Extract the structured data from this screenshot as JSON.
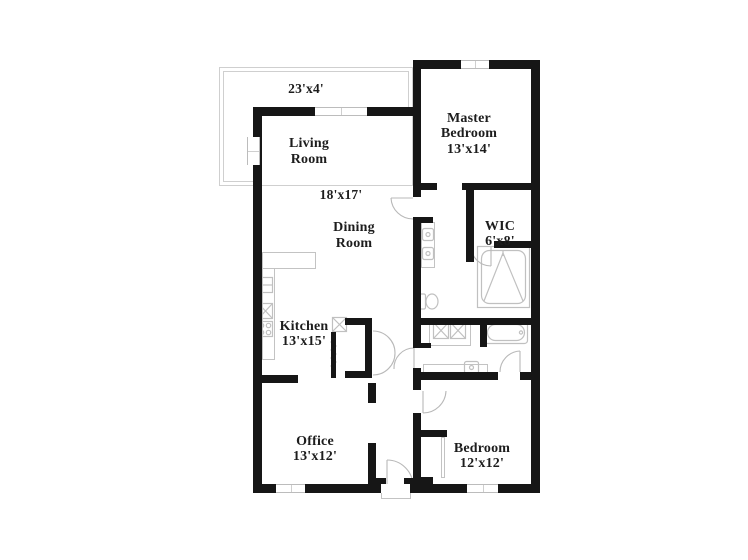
{
  "page": {
    "kind": "floor-plan"
  },
  "labels": {
    "patio_dims": "23'x4'",
    "living": {
      "name": "Living\nRoom",
      "dims": "18'x17'"
    },
    "dining": {
      "name": "Dining\nRoom"
    },
    "master": {
      "name": "Master\nBedroom",
      "dims": "13'x14'"
    },
    "wic": {
      "name": "WIC",
      "dims": "6'x8'"
    },
    "kitchen": {
      "name": "Kitchen",
      "dims": "13'x15'"
    },
    "office": {
      "name": "Office",
      "dims": "13'x12'"
    },
    "bedroom": {
      "name": "Bedroom",
      "dims": "12'x12'"
    }
  },
  "colors": {
    "wall": "#161616",
    "fixture_outline": "#c3c3c3",
    "text": "#1d1d1d",
    "patio_outline": "#cfcfcf"
  },
  "icons": [
    "shower-icon",
    "toilet-icon",
    "double-vanity-icon",
    "bathtub-icon",
    "washer-icon",
    "dryer-icon",
    "kitchen-sink-icon",
    "stove-icon",
    "fridge-icon",
    "pantry-cabinet-icon",
    "hall-sink-icon",
    "door-arc-icon",
    "window-icon",
    "entry-step-icon"
  ]
}
